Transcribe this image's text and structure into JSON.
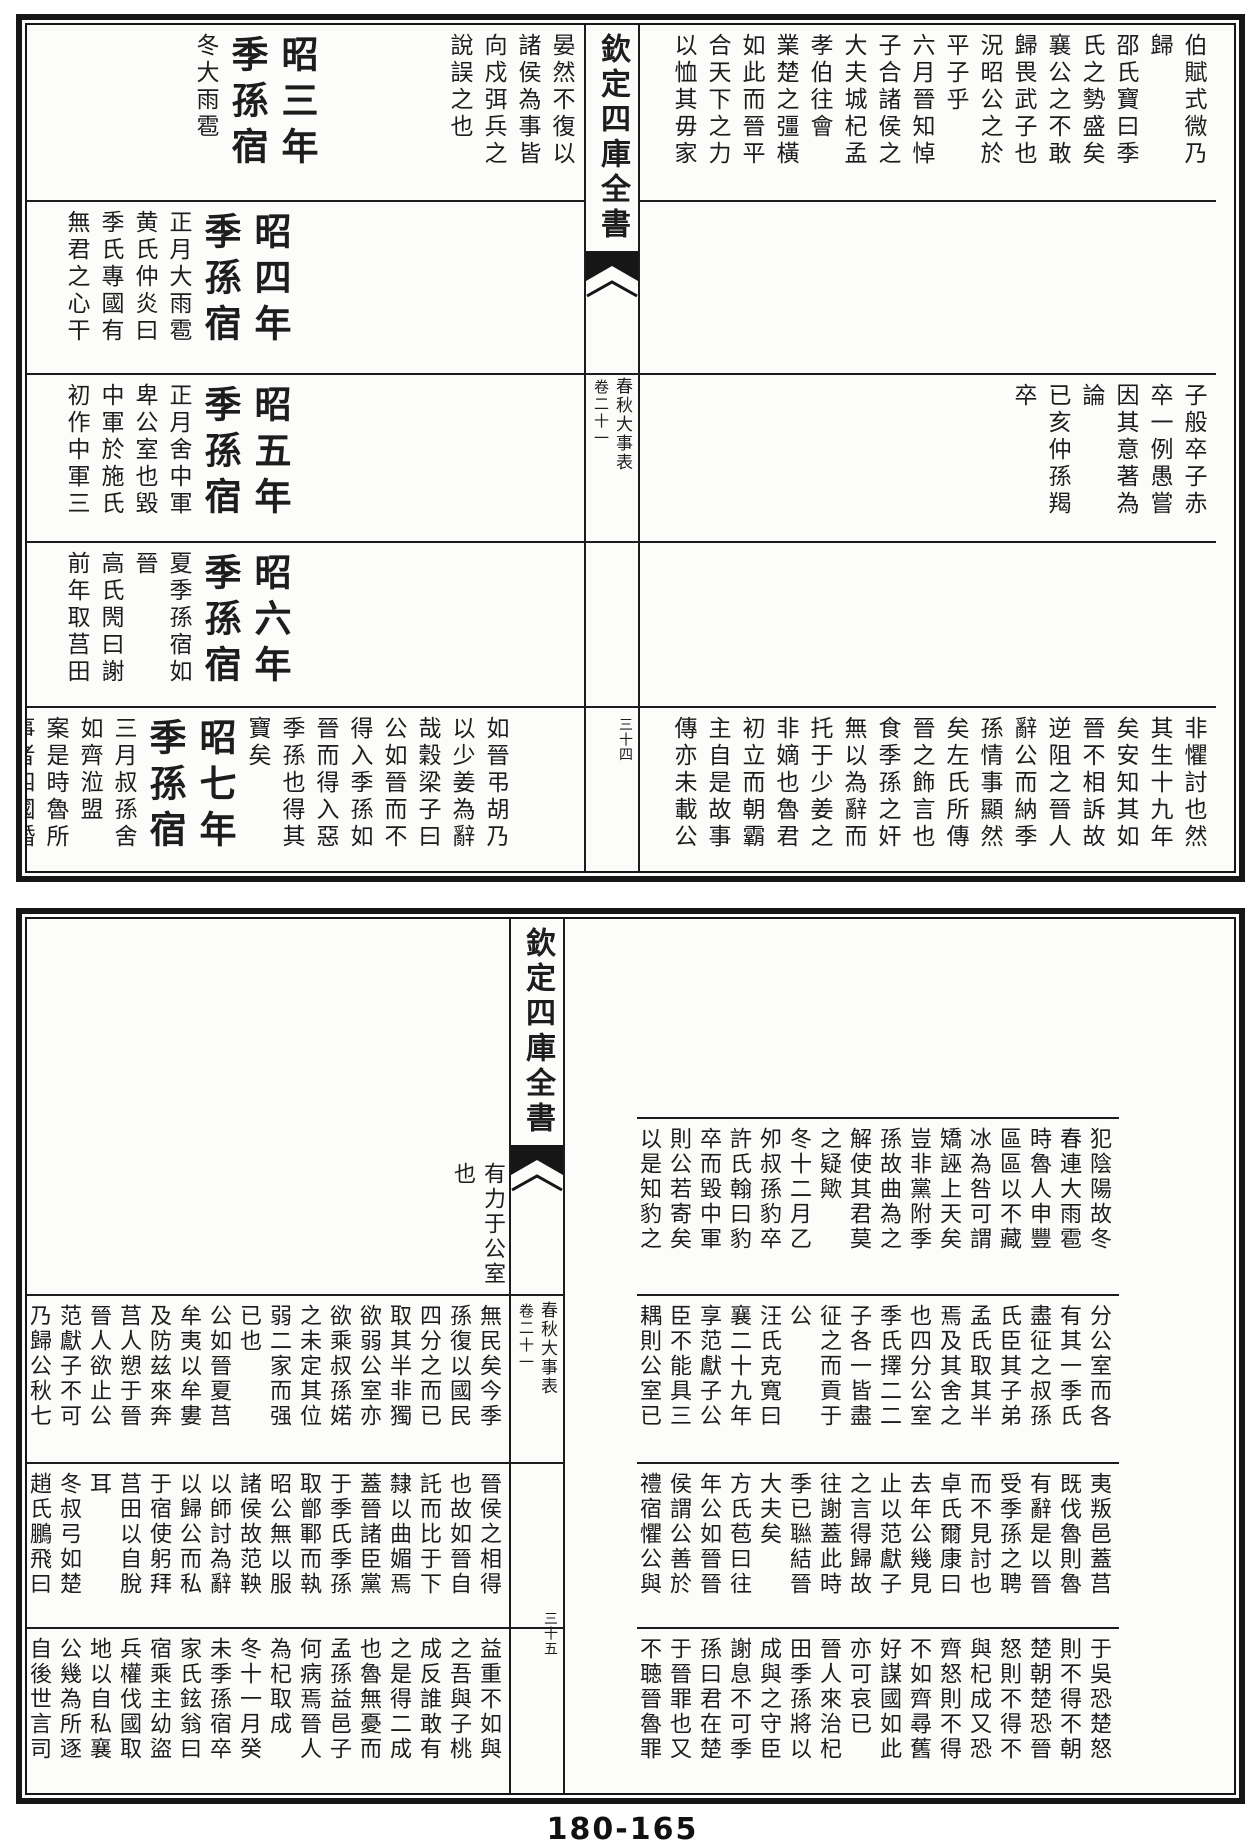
{
  "paper_color": "#fcfcfa",
  "ink_color": "#1d1d1d",
  "footer": {
    "page_number": "180-165"
  },
  "pages": [
    {
      "id": "top",
      "strip": {
        "library_title": "欽定四庫全書",
        "book_title": "春秋大事表",
        "volume": "卷二十一",
        "folio": "三十四"
      },
      "right_rows": [
        {
          "h": 177,
          "cols": [
            "伯賦式微乃",
            "歸",
            "邵氏寶曰季",
            "氏之勢盛矣",
            "襄公之不敢",
            "歸畏武子也",
            "況昭公之於",
            "平子乎",
            "六月晉知悼",
            "子合諸侯之",
            "大夫城杞孟",
            "孝伯往會",
            "業楚之彊橫",
            "如此而晉平",
            "合天下之力",
            "以恤其毋家"
          ]
        },
        {
          "h": 173,
          "cols": []
        },
        {
          "h": 168,
          "cols": [
            "子般卒子赤",
            "卒一例愚嘗",
            "因其意著為",
            "論",
            "已亥仲孫羯",
            "卒"
          ]
        },
        {
          "h": 165,
          "cols": []
        },
        {
          "h": 163,
          "cols": [
            "非懼討也然",
            "其生十九年",
            "矣安知其如",
            "晉不相訴故",
            "逆阻之晉人",
            "辭公而納季",
            "孫情事顯然",
            "矣左氏所傳",
            "晉之飾言也",
            "食季孫之奸",
            "無以為辭而",
            "托于少姜之",
            "非嫡也魯君",
            "初立而朝霸",
            "主自是故事",
            "傳亦未載公"
          ]
        }
      ],
      "left_rows": [
        {
          "h": 177,
          "cols": [
            "晏然不復以",
            "諸侯為事皆",
            "向戍弭兵之",
            "說誤之也",
            {
              "gap": 120
            },
            {
              "t": "昭三年",
              "lg": 1
            },
            {
              "t": "季孫宿",
              "lg": 1
            },
            "冬大雨雹"
          ]
        },
        {
          "h": 173,
          "cols": [
            {
              "gap": 283
            },
            {
              "t": "昭四年",
              "lg": 1
            },
            {
              "t": "季孫宿",
              "lg": 1
            },
            "正月大雨雹",
            "黄氏仲炎曰",
            "季氏專國有",
            "無君之心干"
          ]
        },
        {
          "h": 168,
          "cols": [
            {
              "gap": 283
            },
            {
              "t": "昭五年",
              "lg": 1
            },
            {
              "t": "季孫宿",
              "lg": 1
            },
            "正月舍中軍",
            "卑公室也毀",
            "中軍於施氏",
            "初作中軍三"
          ]
        },
        {
          "h": 165,
          "cols": [
            {
              "gap": 283
            },
            {
              "t": "昭六年",
              "lg": 1
            },
            {
              "t": "季孫宿",
              "lg": 1
            },
            "夏季孫宿如",
            "晉",
            "高氏閌曰謝",
            "前年取莒田"
          ]
        },
        {
          "h": 163,
          "cols": [
            {
              "gap": 66
            },
            "如晉弔胡乃",
            "以少姜為辭",
            "哉穀梁子曰",
            "公如晉而不",
            "得入季孫如",
            "晉而得入惡",
            "季孫也得其",
            "寶矣",
            {
              "t": "昭七年",
              "lg": 1
            },
            {
              "t": "季孫宿",
              "lg": 1
            },
            "三月叔孫舍",
            "如齊涖盟",
            "案是時魯所",
            "事者四國婚"
          ]
        }
      ]
    },
    {
      "id": "bottom",
      "strip": {
        "library_title": "欽定四庫全書",
        "book_title": "春秋大事表",
        "volume": "卷二十一",
        "folio": "三十五"
      },
      "spill": {
        "cols": [
          "有力于公室",
          "也"
        ]
      },
      "right_rows": [
        {
          "h": 200,
          "cols": []
        },
        {
          "h": 177,
          "cols": [
            "犯陰陽故冬",
            "春連大雨雹",
            "時魯人申豐",
            "區區以不藏",
            "冰為咎可謂",
            "矯誣上天矣",
            "豈非黨附季",
            "孫故曲為之",
            "解使其君莫",
            "之疑歟",
            "冬十二月乙",
            "夘叔孫豹卒",
            "許氏翰曰豹",
            "卒而毀中軍",
            "則公若寄矣",
            "以是知豹之"
          ]
        },
        {
          "h": 168,
          "cols": [
            "分公室而各",
            "有其一季氏",
            "盡征之叔孫",
            "氏臣其子弟",
            "孟氏取其半",
            "焉及其舍之",
            "也四分公室",
            "季氏擇二二",
            "子各一皆盡",
            "征之而貢于",
            "公",
            "汪氏克寬曰",
            "襄二十九年",
            "享范獻子公",
            "臣不能具三",
            "耦則公室已"
          ]
        },
        {
          "h": 165,
          "cols": [
            "夷叛邑蓋莒",
            "既伐魯則魯",
            "有辭是以晉",
            "受季孫之聘",
            "而不見討也",
            "卓氏爾康曰",
            "去年公幾見",
            "止以范獻子",
            "之言得歸故",
            "往謝蓋此時",
            "季已聮結晉",
            "大夫矣",
            "方氏苞曰往",
            "年公如晉晉",
            "侯謂公善於",
            "禮宿懼公與"
          ]
        },
        {
          "h": 164,
          "cols": [
            "于吳恐楚怒",
            "則不得不朝",
            "楚朝楚恐晉",
            "怒則不得不",
            "與杞成又恐",
            "齊怒則不得",
            "不如齊尋舊",
            "好謀國如此",
            "亦可哀已",
            "晉人來治杞",
            "田季孫將以",
            "成與之守臣",
            "謝息不可季",
            "孫曰君在楚",
            "于晉罪也又",
            "不聴晉魯罪"
          ]
        }
      ],
      "left_rows": [
        {
          "h": 377,
          "cols": []
        },
        {
          "h": 168,
          "cols": [
            "無民矣今季",
            "孫復以國民",
            "四分之而已",
            "取其半非獨",
            "欲弱公室亦",
            "欲乘叔孫婼",
            "之未定其位",
            "弱二家而强",
            "已也",
            "公如晉夏莒",
            "牟夷以牟婁",
            "及防兹來奔",
            "莒人愬于晉",
            "晉人欲止公",
            "范獻子不可",
            "乃歸公秋七"
          ]
        },
        {
          "h": 165,
          "cols": [
            "晉侯之相得",
            "也故如晉自",
            "託而比于下",
            "隸以曲媚焉",
            "蓋晉諸臣黨",
            "于季氏季孫",
            "取鄫鄆而執",
            "昭公無以服",
            "諸侯故范鞅",
            "以師討為辭",
            "以歸公而私",
            "于宿使躬拜",
            "莒田以自脫",
            "耳",
            "冬叔弓如楚",
            "趙氏鵬飛曰"
          ]
        },
        {
          "h": 164,
          "cols": [
            "益重不如與",
            "之吾與子桃",
            "成反誰敢有",
            "之是得二成",
            "也魯無憂而",
            "孟孫益邑子",
            "何病焉晉人",
            "為杞取成",
            "冬十一月癸",
            "未季孫宿卒",
            "家氏鉉翁曰",
            "宿乘主幼盜",
            "兵權伐國取",
            "地以自私襄",
            "公幾為所逐",
            "自後世言司"
          ]
        }
      ]
    }
  ]
}
